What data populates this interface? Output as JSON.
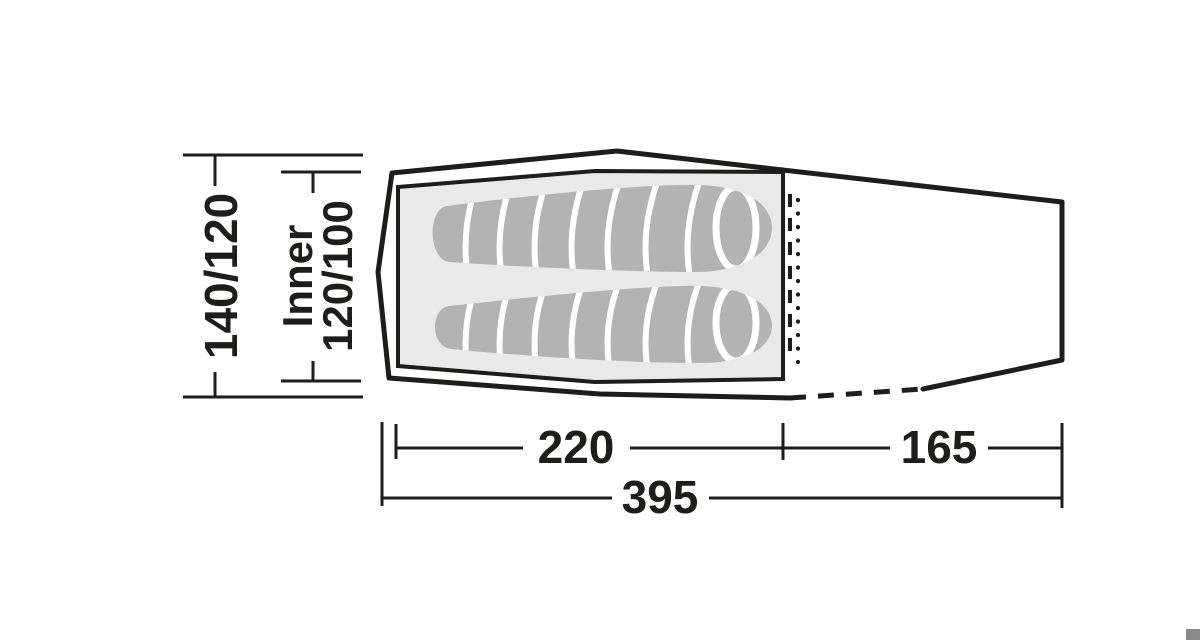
{
  "diagram": {
    "type": "tent-floorplan-top-view",
    "labels": {
      "outer_width": "140/120",
      "inner_prefix": "Inner",
      "inner_width": "120/100",
      "inner_length": "220",
      "vestibule_length": "165",
      "total_length": "395"
    },
    "colors": {
      "line": "#1d1d1b",
      "inner_floor": "#e9e9e9",
      "sleeping_bag": "#b3b3b3",
      "segment_line": "#ffffff",
      "corner_mark": "#8a8a8a",
      "background": "#ffffff"
    }
  }
}
